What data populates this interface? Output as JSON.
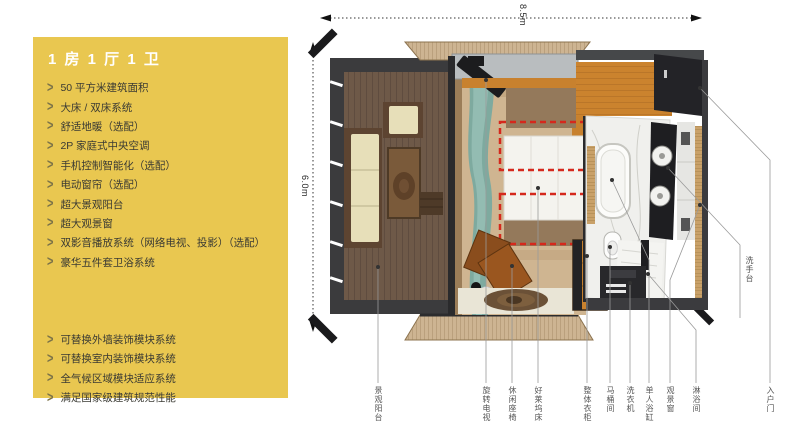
{
  "sidebar": {
    "bg_color": "#e9c750",
    "bullet": ">",
    "title": "1 房 1 厅 1 卫",
    "features": [
      "50 平方米建筑面积",
      "大床 / 双床系统",
      "舒适地暖（选配）",
      "2P 家庭式中央空调",
      "手机控制智能化（选配）",
      "电动窗帘（选配）",
      "超大景观阳台",
      "超大观景窗",
      "双影音播放系统（网络电视、投影）（选配）",
      "豪华五件套卫浴系统"
    ],
    "modules": [
      "可替换外墙装饰模块系统",
      "可替换室内装饰模块系统",
      "全气候区域模块适应系统",
      "满足国家级建筑规范性能"
    ]
  },
  "plan": {
    "dim_width": "8.5m",
    "dim_height": "6.0m",
    "accent_dash_color": "#d5281c",
    "callouts": [
      "景观阳台",
      "旋转电视",
      "休闲座椅",
      "好莱坞床",
      "整体衣柜",
      "马桶间",
      "洗衣机",
      "单人浴缸",
      "观景窗",
      "淋浴间",
      "入户门"
    ],
    "side_callout": "洗手台"
  }
}
